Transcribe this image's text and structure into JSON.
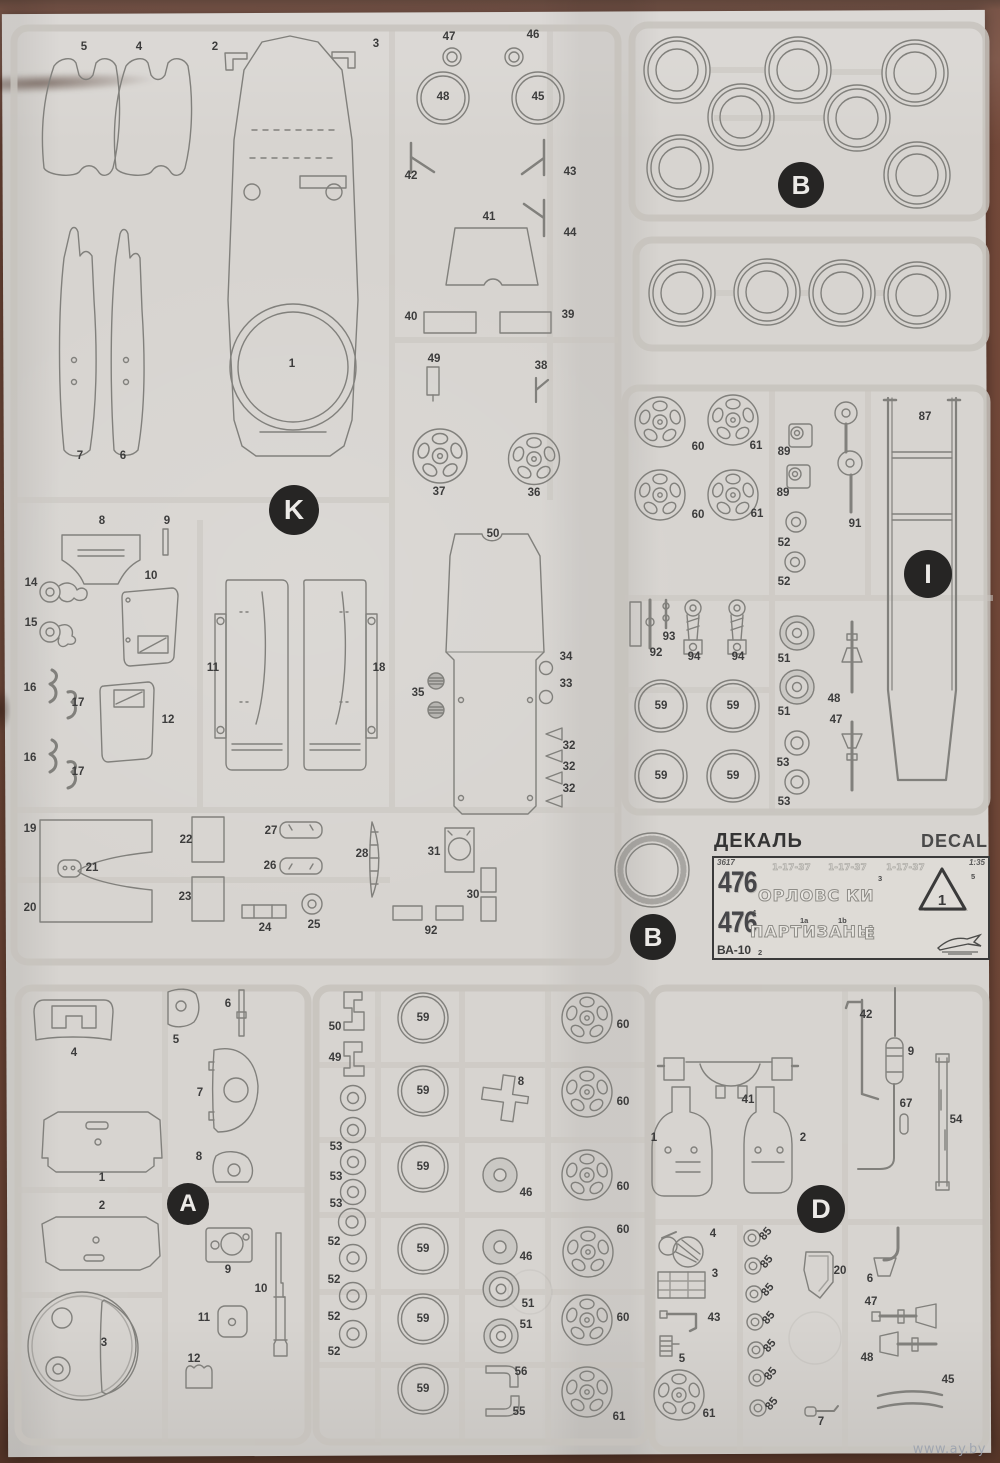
{
  "page": {
    "watermark": "www.ay.by",
    "paper_color": "#d7d4d0",
    "background_color": "#6f4737",
    "line_color": "#81807c"
  },
  "decal": {
    "title_ru": "ДЕКАЛЬ",
    "title_en": "DECAL",
    "kit_no": "3617",
    "scale": "1:35",
    "plate_top": "476",
    "plate_bottom": "476",
    "slogan_1a": "ОРЛОВС",
    "slogan_1b": "КИ",
    "slogan_2": "ПАРТИЗАНЫ",
    "slogan_2e": "Е",
    "vehicle": "ВА-10",
    "triangle_number": "1",
    "brand_logo": "zvezda-eagle-icon",
    "faint_plates": [
      {
        "t": "1-17-37",
        "x": 58
      },
      {
        "t": "1-17-37",
        "x": 114
      },
      {
        "t": "1-17-37",
        "x": 172
      }
    ],
    "refs": [
      {
        "t": "4",
        "x": 38,
        "y": 50
      },
      {
        "t": "1a",
        "x": 86,
        "y": 58
      },
      {
        "t": "1b",
        "x": 124,
        "y": 58
      },
      {
        "t": "3",
        "x": 164,
        "y": 16
      },
      {
        "t": "5",
        "x": 257,
        "y": 14
      },
      {
        "t": "2",
        "x": 44,
        "y": 90
      }
    ]
  },
  "badges": [
    {
      "letter": "K",
      "x": 294,
      "y": 510,
      "d": 50
    },
    {
      "letter": "B",
      "x": 801,
      "y": 185,
      "d": 46
    },
    {
      "letter": "I",
      "x": 928,
      "y": 574,
      "d": 48
    },
    {
      "letter": "B",
      "x": 653,
      "y": 937,
      "d": 46
    },
    {
      "letter": "A",
      "x": 188,
      "y": 1204,
      "d": 42
    },
    {
      "letter": "D",
      "x": 821,
      "y": 1209,
      "d": 48
    }
  ],
  "part_labels": [
    {
      "t": "5",
      "x": 84,
      "y": 47
    },
    {
      "t": "4",
      "x": 139,
      "y": 47
    },
    {
      "t": "2",
      "x": 215,
      "y": 47
    },
    {
      "t": "3",
      "x": 376,
      "y": 44
    },
    {
      "t": "47",
      "x": 449,
      "y": 37
    },
    {
      "t": "46",
      "x": 533,
      "y": 35
    },
    {
      "t": "48",
      "x": 443,
      "y": 97
    },
    {
      "t": "45",
      "x": 538,
      "y": 97
    },
    {
      "t": "42",
      "x": 411,
      "y": 176
    },
    {
      "t": "43",
      "x": 570,
      "y": 172
    },
    {
      "t": "44",
      "x": 570,
      "y": 233
    },
    {
      "t": "41",
      "x": 489,
      "y": 217
    },
    {
      "t": "40",
      "x": 411,
      "y": 317
    },
    {
      "t": "39",
      "x": 568,
      "y": 315
    },
    {
      "t": "49",
      "x": 434,
      "y": 359
    },
    {
      "t": "38",
      "x": 541,
      "y": 366
    },
    {
      "t": "1",
      "x": 292,
      "y": 364
    },
    {
      "t": "37",
      "x": 439,
      "y": 492
    },
    {
      "t": "36",
      "x": 534,
      "y": 493
    },
    {
      "t": "7",
      "x": 80,
      "y": 456
    },
    {
      "t": "6",
      "x": 123,
      "y": 456
    },
    {
      "t": "8",
      "x": 102,
      "y": 521
    },
    {
      "t": "9",
      "x": 167,
      "y": 521
    },
    {
      "t": "14",
      "x": 31,
      "y": 583
    },
    {
      "t": "10",
      "x": 151,
      "y": 576
    },
    {
      "t": "15",
      "x": 31,
      "y": 623
    },
    {
      "t": "16",
      "x": 30,
      "y": 688
    },
    {
      "t": "17",
      "x": 78,
      "y": 703
    },
    {
      "t": "12",
      "x": 168,
      "y": 720
    },
    {
      "t": "16",
      "x": 30,
      "y": 758
    },
    {
      "t": "17",
      "x": 78,
      "y": 772
    },
    {
      "t": "11",
      "x": 213,
      "y": 668
    },
    {
      "t": "18",
      "x": 379,
      "y": 668
    },
    {
      "t": "35",
      "x": 418,
      "y": 693
    },
    {
      "t": "50",
      "x": 493,
      "y": 534
    },
    {
      "t": "34",
      "x": 566,
      "y": 657
    },
    {
      "t": "33",
      "x": 566,
      "y": 684
    },
    {
      "t": "32",
      "x": 569,
      "y": 746
    },
    {
      "t": "32",
      "x": 569,
      "y": 767
    },
    {
      "t": "32",
      "x": 569,
      "y": 789
    },
    {
      "t": "19",
      "x": 30,
      "y": 829
    },
    {
      "t": "21",
      "x": 92,
      "y": 868
    },
    {
      "t": "20",
      "x": 30,
      "y": 908
    },
    {
      "t": "22",
      "x": 186,
      "y": 840
    },
    {
      "t": "23",
      "x": 185,
      "y": 897
    },
    {
      "t": "27",
      "x": 271,
      "y": 831
    },
    {
      "t": "26",
      "x": 270,
      "y": 866
    },
    {
      "t": "24",
      "x": 265,
      "y": 928
    },
    {
      "t": "25",
      "x": 314,
      "y": 925
    },
    {
      "t": "28",
      "x": 362,
      "y": 854
    },
    {
      "t": "31",
      "x": 434,
      "y": 852
    },
    {
      "t": "30",
      "x": 473,
      "y": 895
    },
    {
      "t": "92",
      "x": 431,
      "y": 931
    },
    {
      "t": "60",
      "x": 698,
      "y": 447
    },
    {
      "t": "61",
      "x": 756,
      "y": 446
    },
    {
      "t": "89",
      "x": 784,
      "y": 452
    },
    {
      "t": "89",
      "x": 783,
      "y": 493
    },
    {
      "t": "60",
      "x": 698,
      "y": 515
    },
    {
      "t": "61",
      "x": 757,
      "y": 514
    },
    {
      "t": "52",
      "x": 784,
      "y": 543
    },
    {
      "t": "52",
      "x": 784,
      "y": 582
    },
    {
      "t": "91",
      "x": 855,
      "y": 524
    },
    {
      "t": "87",
      "x": 925,
      "y": 417
    },
    {
      "t": "92",
      "x": 656,
      "y": 653
    },
    {
      "t": "93",
      "x": 669,
      "y": 637
    },
    {
      "t": "94",
      "x": 694,
      "y": 657
    },
    {
      "t": "94",
      "x": 738,
      "y": 657
    },
    {
      "t": "51",
      "x": 784,
      "y": 659
    },
    {
      "t": "51",
      "x": 784,
      "y": 712
    },
    {
      "t": "48",
      "x": 834,
      "y": 699
    },
    {
      "t": "47",
      "x": 836,
      "y": 720
    },
    {
      "t": "59",
      "x": 661,
      "y": 706
    },
    {
      "t": "59",
      "x": 733,
      "y": 706
    },
    {
      "t": "59",
      "x": 661,
      "y": 776
    },
    {
      "t": "59",
      "x": 733,
      "y": 776
    },
    {
      "t": "53",
      "x": 783,
      "y": 763
    },
    {
      "t": "53",
      "x": 784,
      "y": 802
    },
    {
      "t": "4",
      "x": 74,
      "y": 1053
    },
    {
      "t": "5",
      "x": 176,
      "y": 1040
    },
    {
      "t": "6",
      "x": 228,
      "y": 1004
    },
    {
      "t": "7",
      "x": 200,
      "y": 1093
    },
    {
      "t": "1",
      "x": 102,
      "y": 1178
    },
    {
      "t": "8",
      "x": 199,
      "y": 1157
    },
    {
      "t": "2",
      "x": 102,
      "y": 1206
    },
    {
      "t": "9",
      "x": 228,
      "y": 1270
    },
    {
      "t": "10",
      "x": 261,
      "y": 1289
    },
    {
      "t": "11",
      "x": 204,
      "y": 1318
    },
    {
      "t": "3",
      "x": 104,
      "y": 1343
    },
    {
      "t": "12",
      "x": 194,
      "y": 1359
    },
    {
      "t": "50",
      "x": 335,
      "y": 1027
    },
    {
      "t": "49",
      "x": 335,
      "y": 1058
    },
    {
      "t": "53",
      "x": 336,
      "y": 1147
    },
    {
      "t": "53",
      "x": 336,
      "y": 1177
    },
    {
      "t": "53",
      "x": 336,
      "y": 1204
    },
    {
      "t": "52",
      "x": 334,
      "y": 1242
    },
    {
      "t": "52",
      "x": 334,
      "y": 1280
    },
    {
      "t": "52",
      "x": 334,
      "y": 1317
    },
    {
      "t": "52",
      "x": 334,
      "y": 1352
    },
    {
      "t": "59",
      "x": 423,
      "y": 1018
    },
    {
      "t": "59",
      "x": 423,
      "y": 1091
    },
    {
      "t": "59",
      "x": 423,
      "y": 1167
    },
    {
      "t": "59",
      "x": 423,
      "y": 1249
    },
    {
      "t": "59",
      "x": 423,
      "y": 1319
    },
    {
      "t": "59",
      "x": 423,
      "y": 1389
    },
    {
      "t": "8",
      "x": 521,
      "y": 1082
    },
    {
      "t": "46",
      "x": 526,
      "y": 1193
    },
    {
      "t": "46",
      "x": 526,
      "y": 1257
    },
    {
      "t": "51",
      "x": 528,
      "y": 1304
    },
    {
      "t": "51",
      "x": 526,
      "y": 1325
    },
    {
      "t": "56",
      "x": 521,
      "y": 1372
    },
    {
      "t": "55",
      "x": 519,
      "y": 1412
    },
    {
      "t": "60",
      "x": 623,
      "y": 1025
    },
    {
      "t": "60",
      "x": 623,
      "y": 1102
    },
    {
      "t": "60",
      "x": 623,
      "y": 1187
    },
    {
      "t": "60",
      "x": 623,
      "y": 1230
    },
    {
      "t": "60",
      "x": 623,
      "y": 1318
    },
    {
      "t": "61",
      "x": 619,
      "y": 1417
    },
    {
      "t": "42",
      "x": 866,
      "y": 1015
    },
    {
      "t": "9",
      "x": 911,
      "y": 1052
    },
    {
      "t": "67",
      "x": 906,
      "y": 1104
    },
    {
      "t": "54",
      "x": 956,
      "y": 1120
    },
    {
      "t": "41",
      "x": 748,
      "y": 1100
    },
    {
      "t": "1",
      "x": 654,
      "y": 1138
    },
    {
      "t": "2",
      "x": 803,
      "y": 1138
    },
    {
      "t": "4",
      "x": 713,
      "y": 1234
    },
    {
      "t": "3",
      "x": 715,
      "y": 1274
    },
    {
      "t": "43",
      "x": 714,
      "y": 1318
    },
    {
      "t": "5",
      "x": 682,
      "y": 1359
    },
    {
      "t": "61",
      "x": 709,
      "y": 1414
    },
    {
      "t": "20",
      "x": 840,
      "y": 1271
    },
    {
      "t": "6",
      "x": 870,
      "y": 1279
    },
    {
      "t": "47",
      "x": 871,
      "y": 1302
    },
    {
      "t": "48",
      "x": 867,
      "y": 1358
    },
    {
      "t": "45",
      "x": 948,
      "y": 1380
    },
    {
      "t": "7",
      "x": 821,
      "y": 1422
    },
    {
      "t": "85",
      "x": 766,
      "y": 1234,
      "r": -50
    },
    {
      "t": "85",
      "x": 767,
      "y": 1262,
      "r": -50
    },
    {
      "t": "85",
      "x": 768,
      "y": 1290,
      "r": -50
    },
    {
      "t": "85",
      "x": 769,
      "y": 1318,
      "r": -50
    },
    {
      "t": "85",
      "x": 770,
      "y": 1346,
      "r": -50
    },
    {
      "t": "85",
      "x": 771,
      "y": 1374,
      "r": -50
    },
    {
      "t": "85",
      "x": 772,
      "y": 1404,
      "r": -50
    }
  ]
}
